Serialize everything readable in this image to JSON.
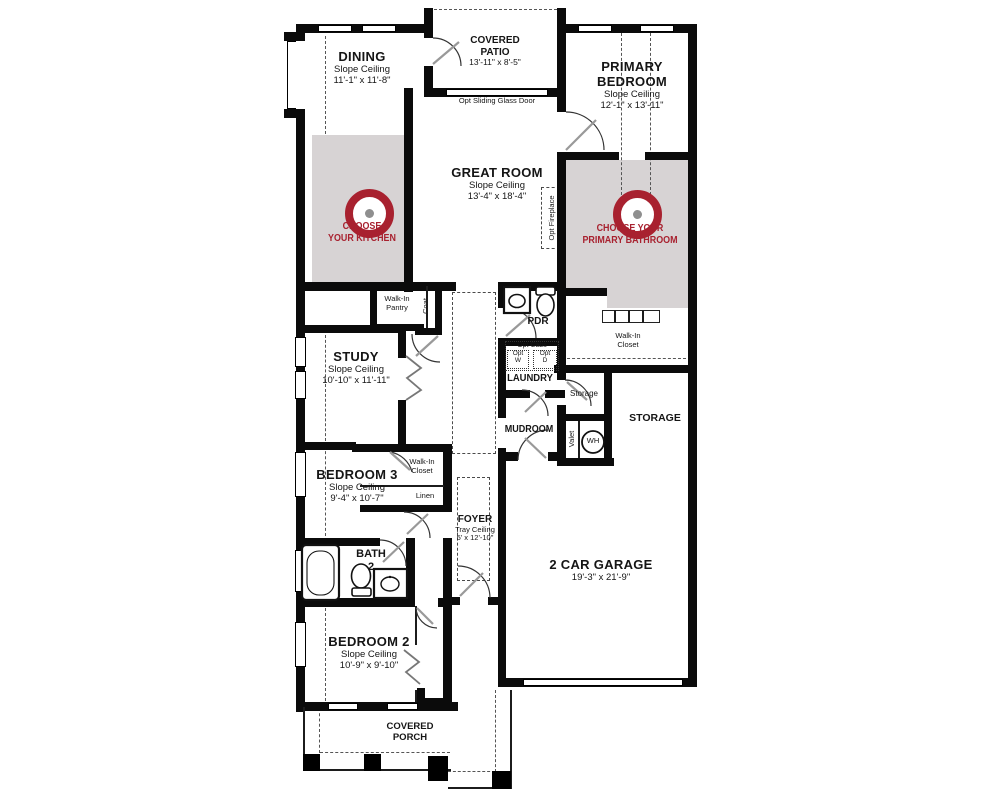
{
  "plan": {
    "rooms": {
      "dining": {
        "name": "DINING",
        "ceiling": "Slope Ceiling",
        "dims": "11'-1\" x 11'-8\""
      },
      "covered_patio": {
        "l1": "COVERED",
        "l2": "PATIO",
        "dims": "13'-11\" x 8'-5\""
      },
      "primary_bedroom": {
        "l1": "PRIMARY",
        "l2": "BEDROOM",
        "ceiling": "Slope Ceiling",
        "dims": "12'-1\" x 13'-11\""
      },
      "great_room": {
        "name": "GREAT ROOM",
        "ceiling": "Slope Ceiling",
        "dims": "13'-4\" x 18'-4\""
      },
      "study": {
        "name": "STUDY",
        "ceiling": "Slope Ceiling",
        "dims": "10'-10\" x 11'-11\""
      },
      "pdr": {
        "name": "PDR"
      },
      "laundry": {
        "name": "LAUNDRY"
      },
      "mudroom": {
        "name": "MUDROOM"
      },
      "walk_in_pantry": {
        "l1": "Walk-In",
        "l2": "Pantry"
      },
      "coat": {
        "name": "Coat"
      },
      "walk_in_closet_primary": {
        "l1": "Walk-In",
        "l2": "Closet"
      },
      "storage_hall": {
        "name": "Storage"
      },
      "storage_garage": {
        "name": "STORAGE"
      },
      "valet": {
        "name": "Valet"
      },
      "water_heater": {
        "name": "WH"
      },
      "bedroom3": {
        "name": "BEDROOM 3",
        "ceiling": "Slope Ceiling",
        "dims": "9'-4\" x 10'-7\""
      },
      "walk_in_closet_bedroom3": {
        "l1": "Walk-In",
        "l2": "Closet"
      },
      "linen": {
        "name": "Linen"
      },
      "foyer": {
        "name": "FOYER",
        "ceiling": "Tray Ceiling",
        "dims": "5' x 12'-10\""
      },
      "bath2": {
        "l1": "BATH",
        "l2": "2"
      },
      "garage": {
        "name": "2 CAR GARAGE",
        "dims": "19'-3\" x 21'-9\""
      },
      "bedroom2": {
        "name": "BEDROOM 2",
        "ceiling": "Slope Ceiling",
        "dims": "10'-9\" x 9'-10\""
      },
      "covered_porch": {
        "l1": "COVERED",
        "l2": "PORCH"
      }
    },
    "options": {
      "sliding_glass_door": "Opt Sliding Glass Door",
      "fireplace": "Opt Fireplace",
      "cabs": "Opt Cabs",
      "washer_l1": "Opt",
      "washer_l2": "W",
      "dryer_l1": "Opt",
      "dryer_l2": "D"
    },
    "cta": {
      "kitchen_l1": "CHOOSE",
      "kitchen_l2": "YOUR KITCHEN",
      "primary_bath_l1": "CHOOSE YOUR",
      "primary_bath_l2": "PRIMARY BATHROOM"
    },
    "colors": {
      "accent_red": "#a8212f",
      "highlight_gray": "#d7d3d4",
      "wall_black": "#0b0b0b",
      "target_center_gray": "#8f8f8f"
    }
  }
}
